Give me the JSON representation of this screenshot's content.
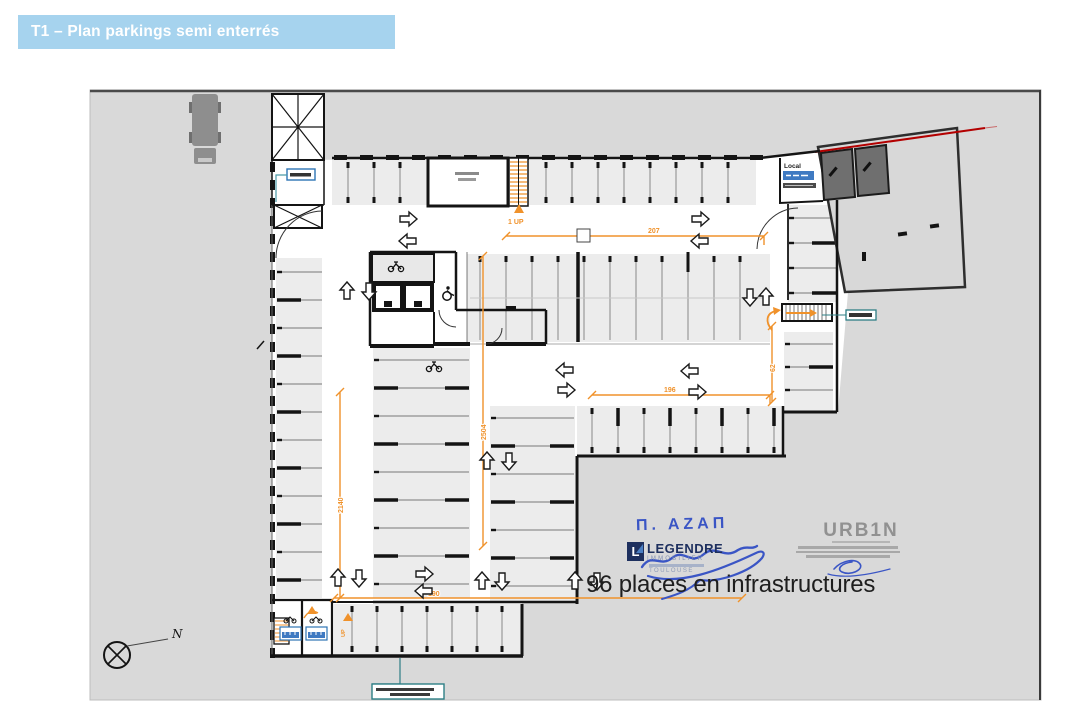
{
  "banner": {
    "title": "T1 – Plan parkings semi enterrés"
  },
  "plan": {
    "caption": "96 places en infrastructures",
    "north_label": "N",
    "local_label": "Local",
    "stairs_label": "1 UP",
    "up_label": "UP",
    "dimensions": {
      "top": "207",
      "mid": "196",
      "left": "2140",
      "center": "2504",
      "bottom": "190",
      "right": "62"
    }
  },
  "stamps": {
    "signature": "Π. ΑΖΑΠ",
    "legendre": {
      "name": "LEGENDRE",
      "sub": "IMMOBILIER",
      "city": "TOULOUSE"
    },
    "urbin": {
      "name": "URB1N"
    }
  },
  "colors": {
    "banner_blue": "#A6D3EE",
    "dimension_orange": "#F0922B",
    "boundary_red": "#B30000",
    "callout_teal": "#2E7F86",
    "signature_blue": "#3A55C5",
    "legendre_navy": "#1D2F5E"
  }
}
